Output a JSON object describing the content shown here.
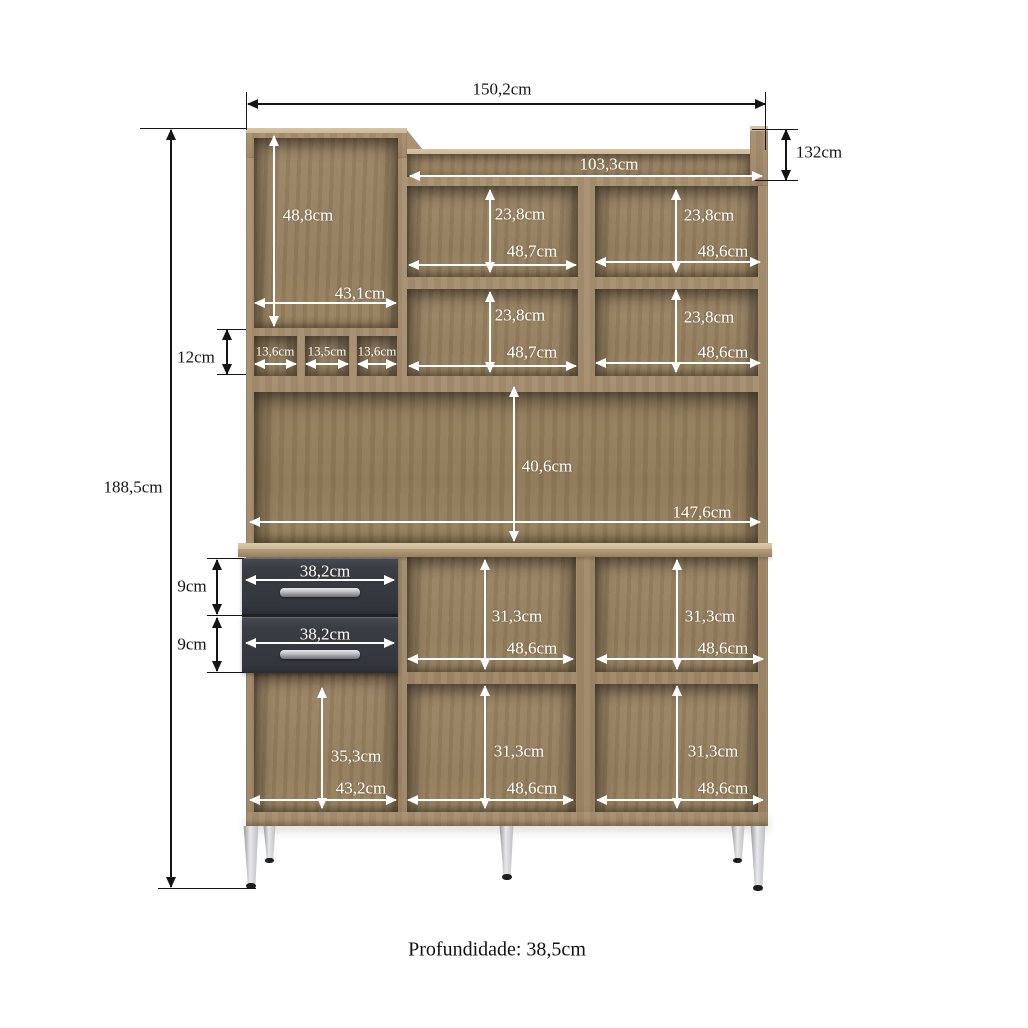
{
  "caption": {
    "text": "Profundidade: 38,5cm"
  },
  "colors": {
    "background": "#ffffff",
    "wood_frame": "#a99272",
    "wood_top_light": "#cdb997",
    "wood_interior": "#9c8566",
    "wood_back": "#96805f",
    "drawer_front": "#3a3d44",
    "handle_light": "#e9eaec",
    "handle_dark": "#6e7076",
    "leg_light": "#e7e8ea",
    "leg_mid": "#b9bbbf",
    "leg_dark": "#8f9195",
    "foot": "#1d1d1f",
    "dim_white": "#ffffff",
    "dim_black": "#141414"
  },
  "dimensions": [
    {
      "id": "width-total",
      "label": "150,2cm",
      "color": "black",
      "lx": 502,
      "ly": 89,
      "h": [
        248,
        765,
        104
      ],
      "lines": [
        [
          246,
          92,
          1,
          38
        ],
        [
          765,
          92,
          1,
          58
        ]
      ]
    },
    {
      "id": "height-total",
      "label": "188,5cm",
      "color": "black",
      "lx": 133,
      "ly": 487,
      "v": [
        130,
        887,
        171
      ],
      "lines": [
        [
          140,
          128,
          106,
          1
        ],
        [
          158,
          888,
          98,
          1
        ]
      ]
    },
    {
      "id": "top-right-height",
      "label": "132cm",
      "color": "black",
      "lx": 819,
      "ly": 152,
      "v": [
        130,
        180,
        786
      ],
      "lines": [
        [
          752,
          129,
          46,
          1
        ],
        [
          755,
          180,
          43,
          1
        ]
      ]
    },
    {
      "id": "cubby-height",
      "label": "12cm",
      "color": "black",
      "lx": 196,
      "ly": 357,
      "v": [
        330,
        374,
        227
      ],
      "lines": [
        [
          217,
          329,
          29,
          1
        ],
        [
          217,
          374,
          29,
          1
        ]
      ]
    },
    {
      "id": "drawer1-height",
      "label": "9cm",
      "color": "black",
      "lx": 192,
      "ly": 586,
      "v": [
        560,
        614,
        217
      ],
      "lines": [
        [
          207,
          558,
          37,
          1
        ],
        [
          207,
          615,
          37,
          1
        ]
      ]
    },
    {
      "id": "drawer2-height",
      "label": "9cm",
      "color": "black",
      "lx": 192,
      "ly": 644,
      "v": [
        618,
        671,
        217
      ],
      "lines": [
        [
          207,
          672,
          37,
          1
        ]
      ]
    },
    {
      "id": "top-shelf-width",
      "label": "103,3cm",
      "color": "white",
      "lx": 609,
      "ly": 164,
      "h": [
        410,
        762,
        176
      ]
    },
    {
      "id": "tall-comp-height",
      "label": "48,8cm",
      "color": "white",
      "lx": 308,
      "ly": 215,
      "v": [
        136,
        326,
        274
      ]
    },
    {
      "id": "tall-comp-width",
      "label": "43,1cm",
      "color": "white",
      "lx": 360,
      "ly": 293,
      "h": [
        255,
        396,
        303
      ]
    },
    {
      "id": "row1-left-height",
      "label": "23,8cm",
      "color": "white",
      "lx": 520,
      "ly": 214,
      "v": [
        190,
        272,
        490
      ]
    },
    {
      "id": "row1-right-height",
      "label": "23,8cm",
      "color": "white",
      "lx": 709,
      "ly": 215,
      "v": [
        190,
        272,
        676
      ]
    },
    {
      "id": "row1-left-width",
      "label": "48,7cm",
      "color": "white",
      "lx": 532,
      "ly": 251,
      "h": [
        409,
        576,
        265
      ]
    },
    {
      "id": "row1-right-width",
      "label": "48,6cm",
      "color": "white",
      "lx": 723,
      "ly": 251,
      "h": [
        596,
        760,
        262
      ]
    },
    {
      "id": "row2-left-height",
      "label": "23,8cm",
      "color": "white",
      "lx": 520,
      "ly": 315,
      "v": [
        292,
        372,
        490
      ]
    },
    {
      "id": "row2-right-height",
      "label": "23,8cm",
      "color": "white",
      "lx": 709,
      "ly": 317,
      "v": [
        290,
        372,
        676
      ]
    },
    {
      "id": "row2-left-width",
      "label": "48,7cm",
      "color": "white",
      "lx": 532,
      "ly": 352,
      "h": [
        409,
        576,
        366
      ]
    },
    {
      "id": "row2-right-width",
      "label": "48,6cm",
      "color": "white",
      "lx": 723,
      "ly": 352,
      "h": [
        596,
        760,
        363
      ]
    },
    {
      "id": "cubby1-width",
      "label": "13,6cm",
      "color": "white",
      "fs": 13,
      "lx": 275,
      "ly": 351,
      "h": [
        255,
        296,
        364
      ]
    },
    {
      "id": "cubby2-width",
      "label": "13,5cm",
      "color": "white",
      "fs": 13,
      "lx": 327,
      "ly": 351,
      "h": [
        306,
        348,
        364
      ]
    },
    {
      "id": "cubby3-width",
      "label": "13,6cm",
      "color": "white",
      "fs": 13,
      "lx": 377,
      "ly": 351,
      "h": [
        358,
        396,
        364
      ]
    },
    {
      "id": "mid-open-height",
      "label": "40,6cm",
      "color": "white",
      "lx": 547,
      "ly": 466,
      "v": [
        387,
        541,
        514
      ]
    },
    {
      "id": "mid-open-width",
      "label": "147,6cm",
      "color": "white",
      "lx": 702,
      "ly": 512,
      "h": [
        250,
        760,
        522
      ]
    },
    {
      "id": "drawer1-width",
      "label": "38,2cm",
      "color": "white",
      "lx": 325,
      "ly": 571,
      "h": [
        246,
        394,
        580
      ]
    },
    {
      "id": "drawer2-width",
      "label": "38,2cm",
      "color": "white",
      "lx": 325,
      "ly": 634,
      "h": [
        246,
        394,
        643
      ]
    },
    {
      "id": "base-top-mid-height",
      "label": "31,3cm",
      "color": "white",
      "lx": 517,
      "ly": 616,
      "v": [
        560,
        669,
        485
      ]
    },
    {
      "id": "base-top-right-height",
      "label": "31,3cm",
      "color": "white",
      "lx": 710,
      "ly": 616,
      "v": [
        560,
        669,
        677
      ]
    },
    {
      "id": "base-top-mid-width",
      "label": "48,6cm",
      "color": "white",
      "lx": 532,
      "ly": 648,
      "h": [
        408,
        573,
        659
      ]
    },
    {
      "id": "base-top-right-width",
      "label": "48,6cm",
      "color": "white",
      "lx": 723,
      "ly": 648,
      "h": [
        597,
        763,
        659
      ]
    },
    {
      "id": "base-bot-left-height",
      "label": "35,3cm",
      "color": "white",
      "lx": 356,
      "ly": 756,
      "v": [
        688,
        808,
        322
      ]
    },
    {
      "id": "base-bot-left-width",
      "label": "43,2cm",
      "color": "white",
      "lx": 361,
      "ly": 788,
      "h": [
        250,
        396,
        800
      ]
    },
    {
      "id": "base-bot-mid-height",
      "label": "31,3cm",
      "color": "white",
      "lx": 519,
      "ly": 751,
      "v": [
        686,
        808,
        485
      ]
    },
    {
      "id": "base-bot-right-height",
      "label": "31,3cm",
      "color": "white",
      "lx": 713,
      "ly": 751,
      "v": [
        686,
        808,
        677
      ]
    },
    {
      "id": "base-bot-mid-width",
      "label": "48,6cm",
      "color": "white",
      "lx": 532,
      "ly": 788,
      "h": [
        408,
        573,
        800
      ]
    },
    {
      "id": "base-bot-right-width",
      "label": "48,6cm",
      "color": "white",
      "lx": 723,
      "ly": 788,
      "h": [
        597,
        763,
        800
      ]
    }
  ]
}
